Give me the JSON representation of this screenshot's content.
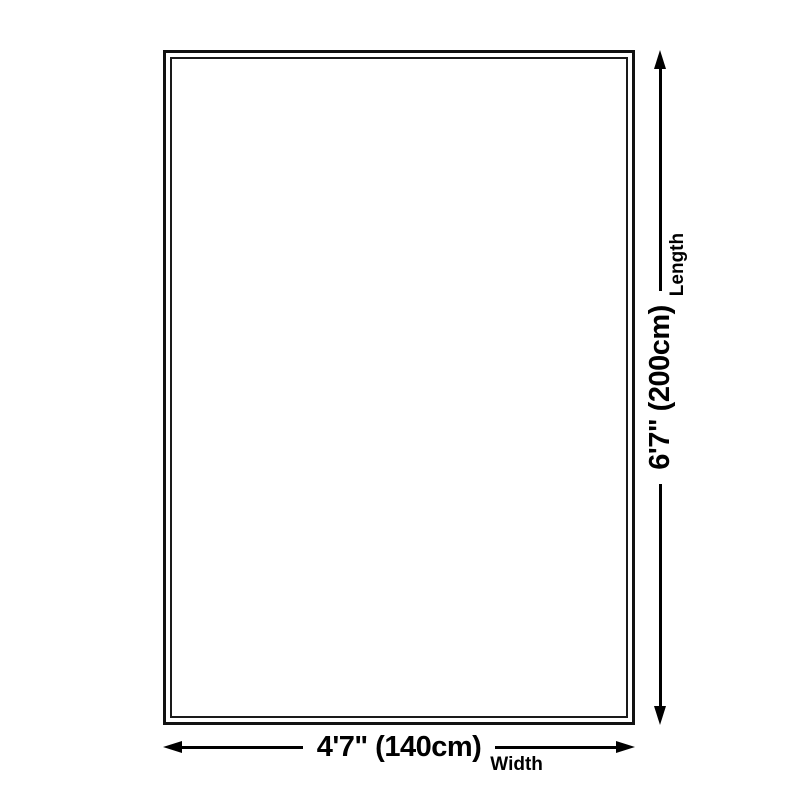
{
  "diagram": {
    "background": "#ffffff",
    "line_color": "#000000",
    "rug": {
      "fill": "#ffffff",
      "border_color": "#111111",
      "border_style": "double"
    },
    "width_dim": {
      "value": "4'7\" (140cm)",
      "label": "Width",
      "start_icon": "arrow-left",
      "end_icon": "arrow-right"
    },
    "length_dim": {
      "value": "6'7\" (200cm)",
      "label": "Length",
      "start_icon": "arrow-down",
      "end_icon": "arrow-up"
    }
  }
}
